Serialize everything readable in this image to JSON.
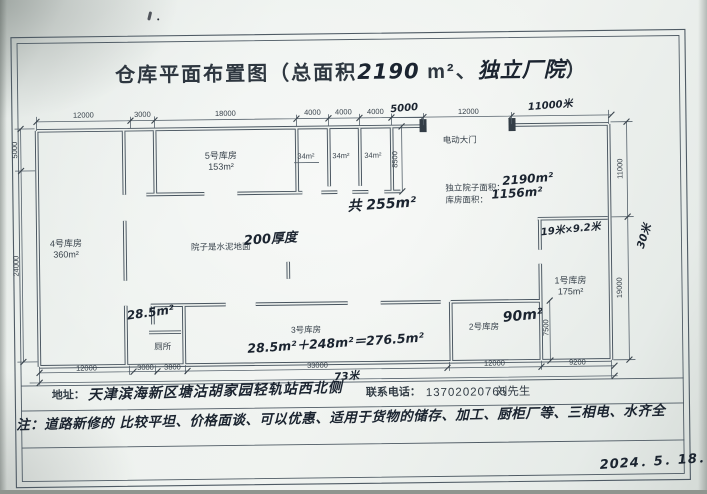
{
  "title": {
    "part1": "仓库平面布置图（总面积",
    "part2": "2190",
    "part3": "m²、",
    "part4": "独立厂院",
    "part5": "）"
  },
  "plan": {
    "rooms": {
      "room5": {
        "name": "5号库房",
        "area": "153m²"
      },
      "room4": {
        "name": "4号库房",
        "area": "360m²"
      },
      "room3": {
        "name": "3号库房"
      },
      "room2": {
        "name": "2号库房",
        "area": "90m²"
      },
      "room1": {
        "name": "1号库房",
        "area": "175m²"
      },
      "smalls": [
        "34m²",
        "34m²",
        "34m²"
      ],
      "toilet": "厕所"
    },
    "labels": {
      "gate": "电动大门",
      "yard_floor": "院子是水泥地面",
      "yard_floor_hand": "200厚度",
      "yard_area_label": "独立院子面积：",
      "yard_area_value": "2190m²",
      "warehouse_area_label": "库房面积：",
      "warehouse_area_value": "1156m²",
      "total_small": "共 255m²",
      "calc": "28.5m²＋248m²＝276.5m²",
      "toilet_area": "28.5m²",
      "room1_size": "19米×9.2米"
    },
    "dims": {
      "top": [
        "12000",
        "3000",
        "18000",
        "4000",
        "4000",
        "4000"
      ],
      "top_hand": "5000",
      "gate_dim": "12000",
      "gate_hand": "11000米",
      "bottom": [
        "12000",
        "3000",
        "3800",
        "33000",
        "12000",
        "9200"
      ],
      "bottom_total_hand": "73米",
      "left": [
        "5000",
        "24000"
      ],
      "right": [
        "11000",
        "19000"
      ],
      "right_total_hand": "30米",
      "small_depth": "8500",
      "room2_depth": "7500"
    }
  },
  "footer": {
    "address_label": "地址：",
    "address": "天津滨海新区塘沽胡家园轻轨站西北侧",
    "phone_label": "联系电话：",
    "phone": "13702020765",
    "contact": "刘先生",
    "note": "注：道路新修的 比较平坦、价格面谈、可以优惠、适用于货物的储存、加工、厨柜厂等、三相电、水齐全",
    "date": "2024．5．18．"
  },
  "colors": {
    "paper": "#eef2ef",
    "line": "#4e5a64",
    "ink_printed": "#39434c",
    "ink_hand": "#1b2430"
  }
}
